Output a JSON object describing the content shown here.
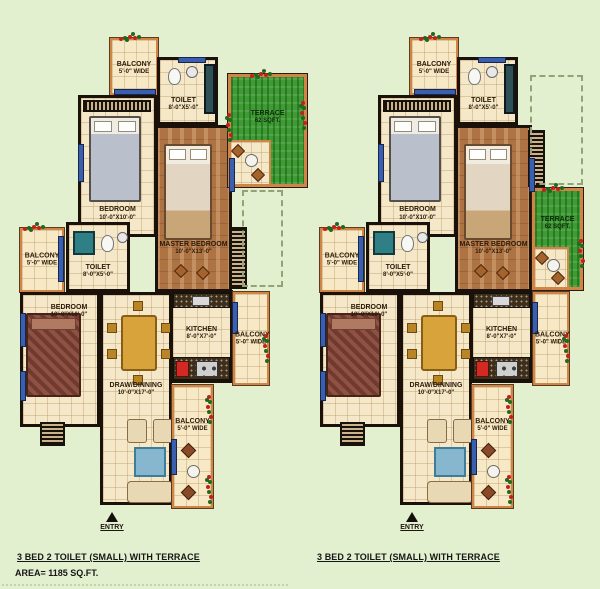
{
  "palette": {
    "background": "#e3f0cf",
    "floor_tile": "#f5e8c9",
    "wall": "#1a120a",
    "terrace_green": "#3f9c35",
    "wood_floor": "#ad7343",
    "balcony_trim_orange": "#d08445",
    "window_blue": "#3a5fae",
    "flower_red": "#c41f1f"
  },
  "plans": [
    {
      "id": "left",
      "caption": "3 BED 2 TOILET (SMALL) WITH TERRACE",
      "area_note": "AREA= 1185 SQ.FT.",
      "entry": "ENTRY",
      "terrace_position": "top-right",
      "rooms": {
        "balcony_top": {
          "label": "BALCONY",
          "dim": "5'-0\" WIDE"
        },
        "toilet_top": {
          "label": "TOILET",
          "dim": "8'-0\"X5'-0\""
        },
        "bedroom_top": {
          "label": "BEDROOM",
          "dim": "10'-0\"X10'-0\""
        },
        "master_bedroom": {
          "label": "MASTER BEDROOM",
          "dim": "10'-0\"X13'-0\""
        },
        "terrace": {
          "label": "TERRACE",
          "dim": "62 SQFT."
        },
        "balcony_left": {
          "label": "BALCONY",
          "dim": "5'-0\" WIDE"
        },
        "toilet_mid": {
          "label": "TOILET",
          "dim": "8'-0\"X5'-0\""
        },
        "bedroom_bottom": {
          "label": "BEDROOM",
          "dim": "10'-0\"X10'-0\""
        },
        "kitchen": {
          "label": "KITCHEN",
          "dim": "8'-0\"X7'-0\""
        },
        "balcony_kitchen": {
          "label": "BALCONY",
          "dim": "5'-0\" WIDE"
        },
        "draw_dining": {
          "label": "DRAW/DINNING",
          "dim": "10'-0\"X17'-0\""
        },
        "balcony_bottom": {
          "label": "BALCONY",
          "dim": "5'-0\" WIDE"
        }
      }
    },
    {
      "id": "right",
      "caption": "3 BED 2 TOILET (SMALL) WITH TERRACE",
      "entry": "ENTRY",
      "terrace_position": "middle-right",
      "rooms": {
        "balcony_top": {
          "label": "BALCONY",
          "dim": "5'-0\" WIDE"
        },
        "toilet_top": {
          "label": "TOILET",
          "dim": "8'-0\"X5'-0\""
        },
        "bedroom_top": {
          "label": "BEDROOM",
          "dim": "10'-0\"X10'-0\""
        },
        "master_bedroom": {
          "label": "MASTER BEDROOM",
          "dim": "10'-0\"X13'-0\""
        },
        "terrace": {
          "label": "TERRACE",
          "dim": "62 SQFT."
        },
        "balcony_left": {
          "label": "BALCONY",
          "dim": "5'-0\" WIDE"
        },
        "toilet_mid": {
          "label": "TOILET",
          "dim": "8'-0\"X5'-0\""
        },
        "bedroom_bottom": {
          "label": "BEDROOM",
          "dim": "10'-0\"X10'-0\""
        },
        "kitchen": {
          "label": "KITCHEN",
          "dim": "8'-0\"X7'-0\""
        },
        "balcony_kitchen": {
          "label": "BALCONY",
          "dim": "5'-0\" WIDE"
        },
        "draw_dining": {
          "label": "DRAW/DINNING",
          "dim": "10'-0\"X17'-0\""
        },
        "balcony_bottom": {
          "label": "BALCONY",
          "dim": "5'-0\" WIDE"
        }
      }
    }
  ]
}
